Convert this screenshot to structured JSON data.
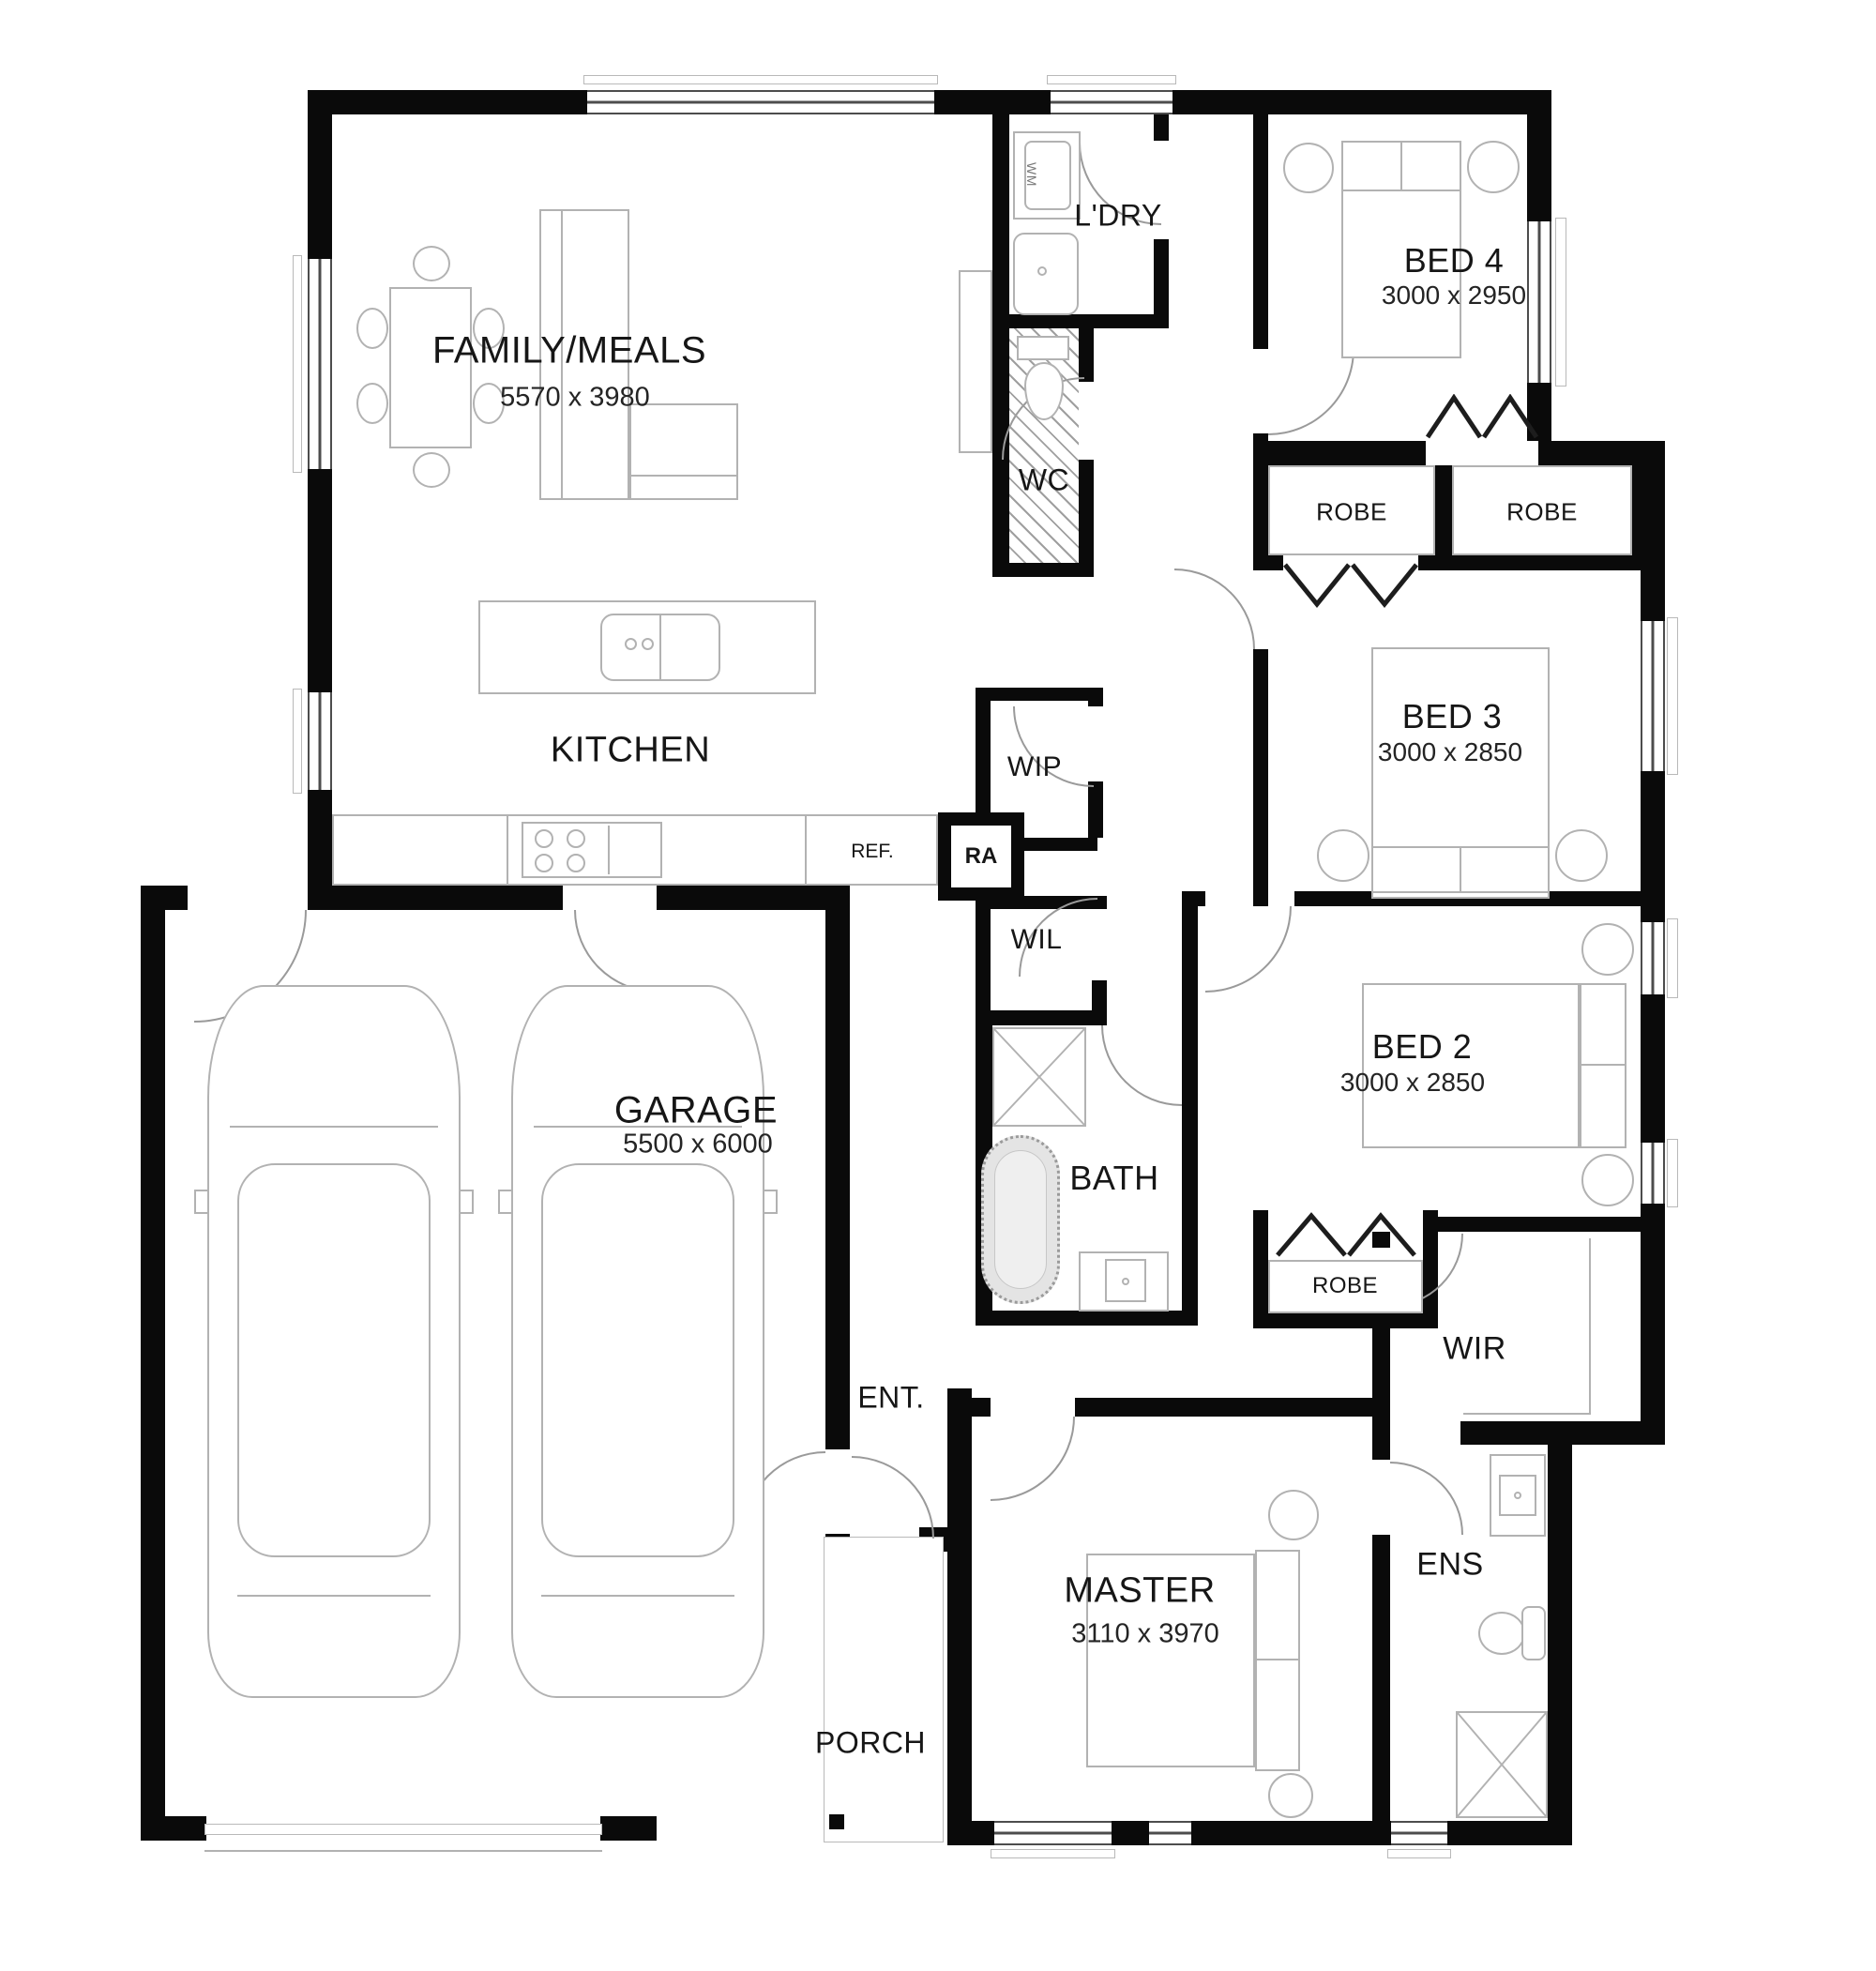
{
  "plan": {
    "type": "residential-floor-plan",
    "wall_color": "#0a0a0a",
    "background": "#ffffff"
  },
  "rooms": {
    "family": {
      "name": "FAMILY/MEALS",
      "dims": "5570 x 3980"
    },
    "kitchen": {
      "name": "KITCHEN"
    },
    "laundry": {
      "name": "L'DRY"
    },
    "wc": {
      "name": "WC"
    },
    "bed4": {
      "name": "BED 4",
      "dims": "3000 x 2950"
    },
    "bed3": {
      "name": "BED 3",
      "dims": "3000 x 2850"
    },
    "bed2": {
      "name": "BED 2",
      "dims": "3000 x 2850"
    },
    "bath": {
      "name": "BATH"
    },
    "wip": {
      "name": "WIP"
    },
    "wil": {
      "name": "WIL"
    },
    "garage": {
      "name": "GARAGE",
      "dims": "5500 x 6000"
    },
    "wir": {
      "name": "WIR"
    },
    "ent": {
      "name": "ENT."
    },
    "master": {
      "name": "MASTER",
      "dims": "3110 x 3970"
    },
    "ens": {
      "name": "ENS"
    },
    "porch": {
      "name": "PORCH"
    }
  },
  "fixtures": {
    "robe": "ROBE",
    "fridge": "REF.",
    "return_air": "RA",
    "washing_machine": "WM"
  }
}
